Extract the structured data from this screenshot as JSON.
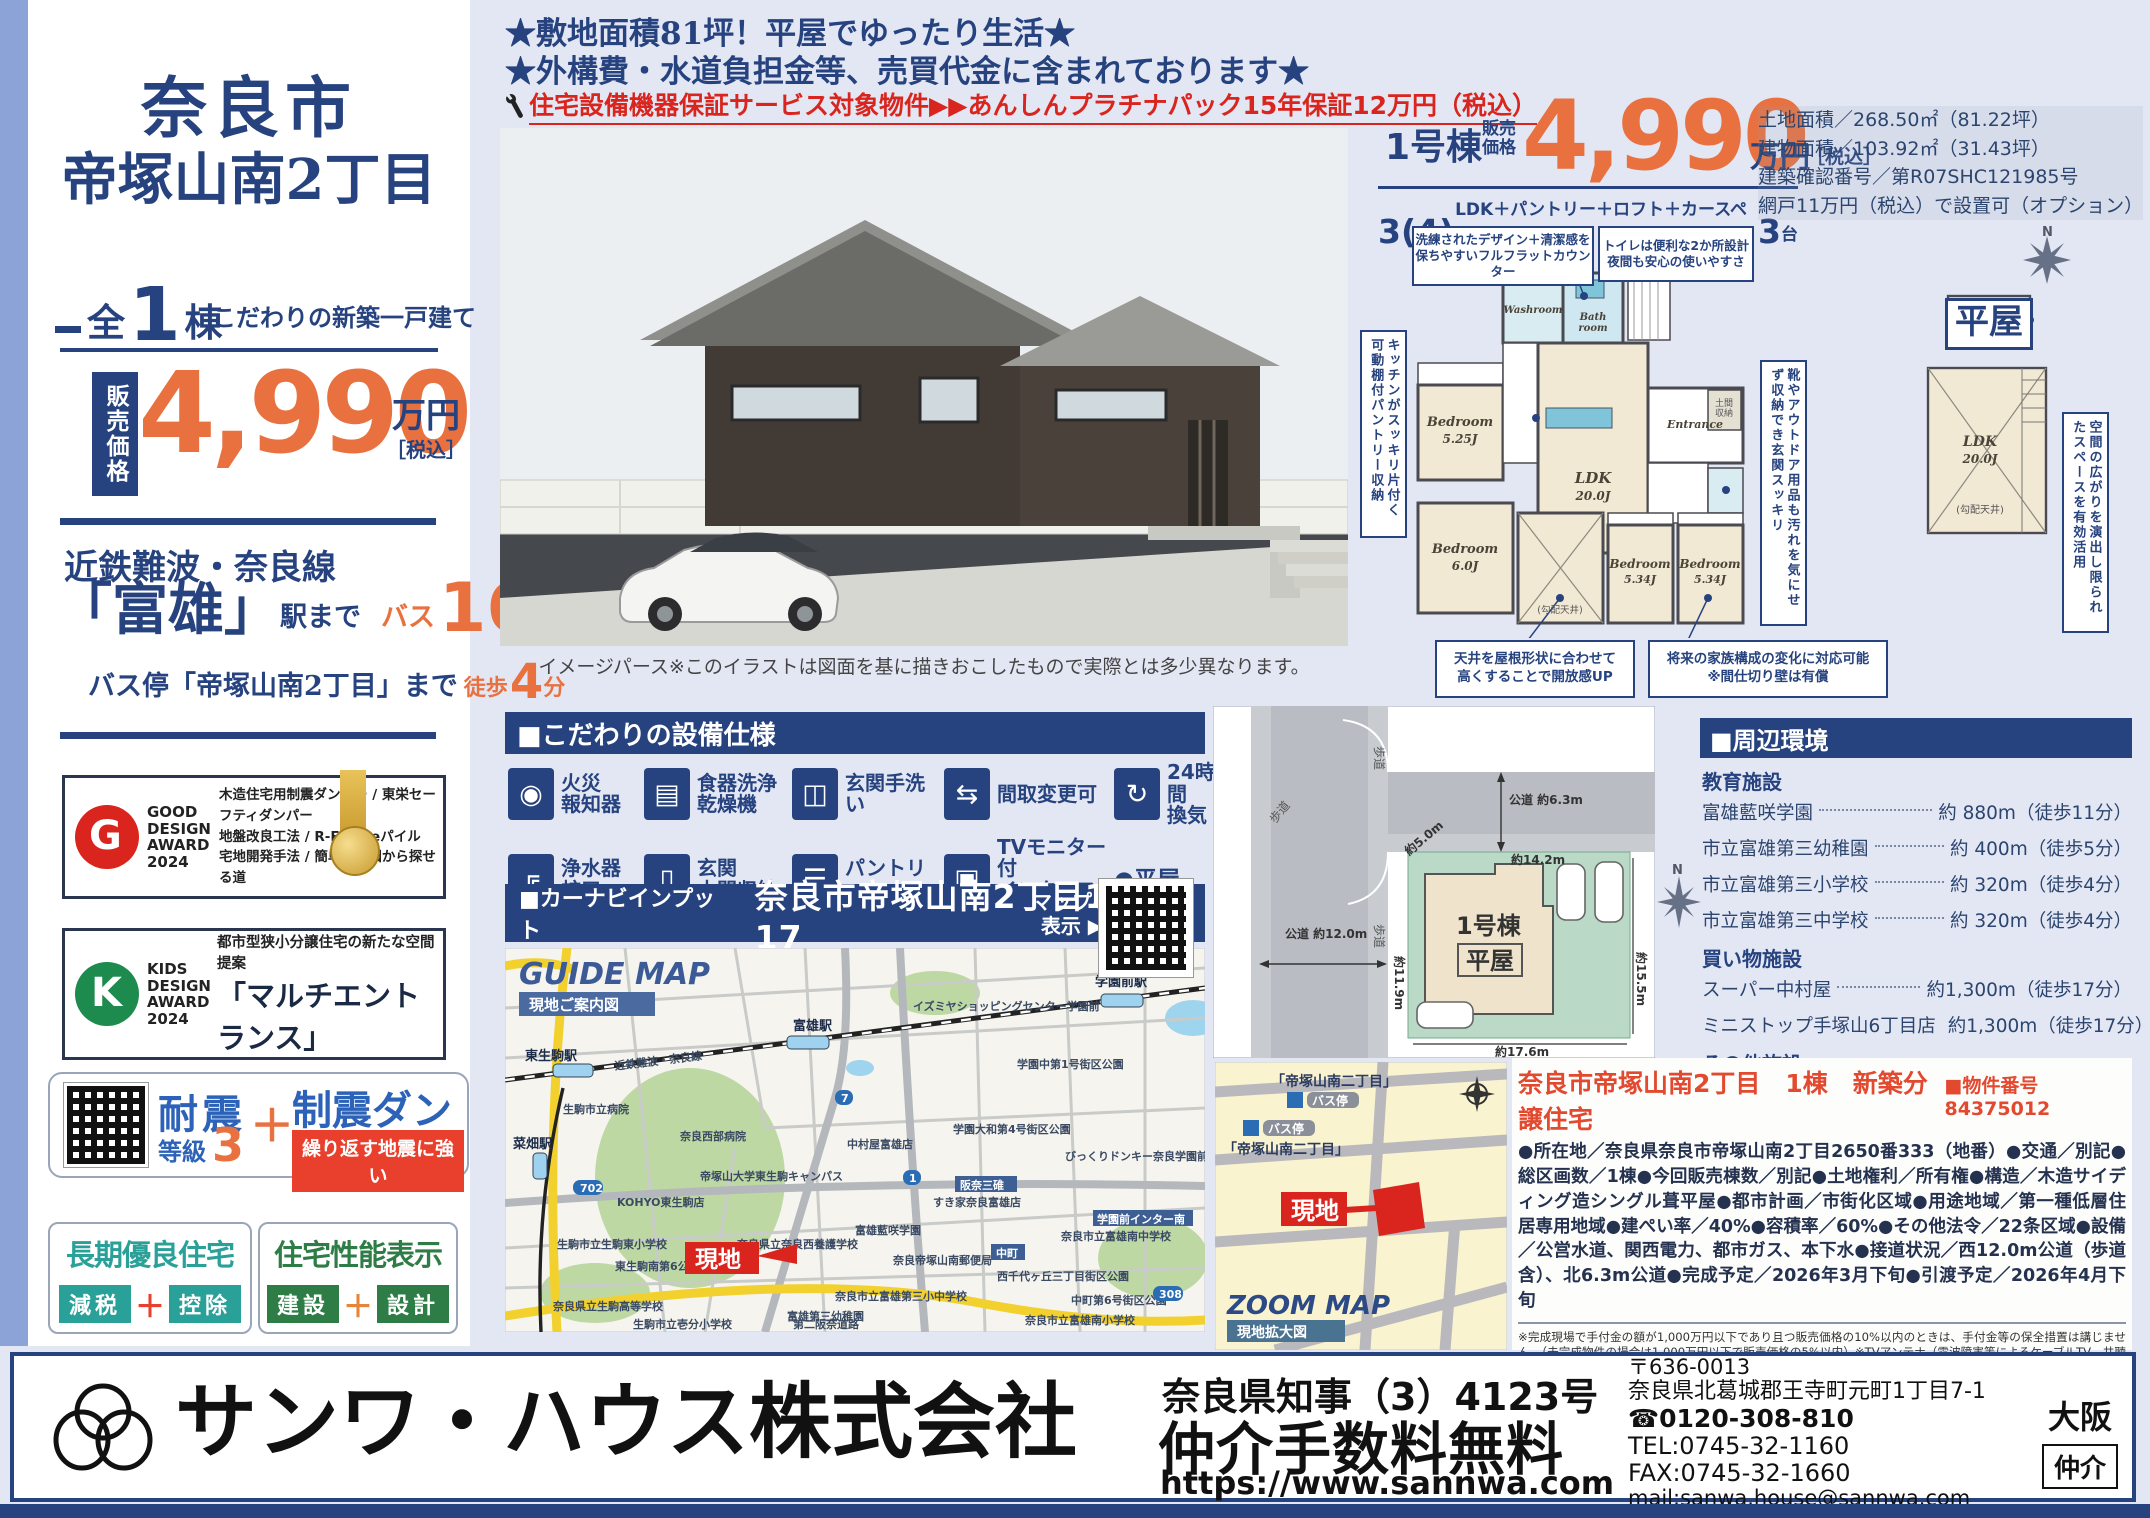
{
  "top": {
    "star1": "★敷地面積81坪！平屋でゆったり生活★",
    "star2": "★外構費・水道負担金等、売買代金に含まれております★",
    "warranty": "住宅設備機器保証サービス対象物件▶▶あんしんプラチナパック15年保証12万円（税込）"
  },
  "sidebar": {
    "title1": "奈良市",
    "title2": "帝塚山南2丁目",
    "zen": "全",
    "count": "1",
    "tou": "棟",
    "note": "こだわりの新築一戸建て",
    "price_label": "販売価格",
    "price": "4,990",
    "price_unit": "万円",
    "price_tax": "［税込］",
    "line_name": "近鉄難波・奈良線",
    "station": "「富雄」",
    "station_suffix": "駅まで",
    "bus_word": "バス",
    "bus_num": "16",
    "bus_unit": "分",
    "busstop": "バス停「帝塚山南2丁目」まで",
    "walk_word": "徒歩",
    "walk_num": "4",
    "walk_unit": "分",
    "gd_award": "GOOD\nDESIGN\nAWARD\n2024",
    "gd_line1": "木造住宅用制震ダンパー / 東栄セーフティダンパー",
    "gd_line2": "地盤改良工法 / R-Evolveパイル",
    "gd_line3": "宅地開発手法 / 簡単に地図から探せる道",
    "kd_award": "KIDS\nDESIGN\nAWARD\n2024",
    "kd_line1": "都市型狭小分譲住宅の新たな空間提案",
    "kd_line2": "「マルチエントランス」",
    "ts_word1": "耐震",
    "ts_grade": "等級",
    "ts_num": "3",
    "ts_plus": "＋",
    "ts_word2": "制震ダンパー",
    "ts_band": "繰り返す地震に強い",
    "ch_title": "長期優良住宅",
    "ch_left": "減税",
    "ch_plus": "＋",
    "ch_right": "控除",
    "sp_title": "住宅性能表示",
    "sp_left": "建設",
    "sp_plus": "＋",
    "sp_right": "設計"
  },
  "render_caption": "イメージパース※このイラストは図面を基に描きおこしたもので実際とは多少異なります。",
  "price_block": {
    "unit": "1号棟",
    "label": "販売\n価格",
    "price": "4,990",
    "yen": "万円",
    "tax": "［税込］",
    "plan_big": "3(4)",
    "plan_mid": "LDK＋パントリー＋ロフト＋カースペース",
    "plan_num": "3",
    "plan_tail": "台",
    "detail1": "土地面積／268.50㎡（81.22坪）",
    "detail2": "建物面積／103.92㎡（31.43坪）",
    "detail3": "建築確認番号／第R07SHC121985号",
    "detail4": "網戸11万円（税込）で設置可（オプション）"
  },
  "floorplan": {
    "badge": "平屋",
    "c_counter": "洗練されたデザイン＋清潔感を\n保ちやすいフルフラットカウンター",
    "c_toilet": "トイレは便利な2か所設計\n夜間も安心の使いやすさ",
    "c_kitchen": "キッチンがスッキリ片付く可動棚付パントリー収納",
    "c_entrance": "靴やアウトドア用品も汚れを気にせず収納でき玄関スッキリ",
    "c_loft": "空間の広がりを演出し限られたスペースを有効活用",
    "c_ceiling": "天井を屋根形状に合わせて\n高くすることで開放感UP",
    "c_future": "将来の家族構成の変化に対応可能\n※間仕切り壁は有償",
    "bed1a": "Bedroom",
    "bed1b": "5.25J",
    "bed2a": "Bedroom",
    "bed2b": "6.0J",
    "ldka": "LDK",
    "ldkb": "20.0J",
    "bed3a": "Bedroom",
    "bed3b": "5.34J",
    "bed4a": "Bedroom",
    "bed4b": "5.34J",
    "wash": "Washroom",
    "bath1": "Bath",
    "bath2": "room",
    "ent": "Entrance",
    "doma1": "土間",
    "doma2": "収納",
    "slope": "(勾配天井)",
    "loft1": "ロフト",
    "loft2": "3.72㎡",
    "loft3": "LDK",
    "loft4": "20.0J",
    "loft5": "(勾配天井)",
    "north": "N"
  },
  "specs": {
    "title": "■こだわりの設備仕様",
    "items": [
      {
        "glyph": "◉",
        "label": "火災\n報知器"
      },
      {
        "glyph": "▤",
        "label": "食器洗浄\n乾燥機"
      },
      {
        "glyph": "◫",
        "label": "玄関手洗い"
      },
      {
        "glyph": "⇆",
        "label": "間取変更可"
      },
      {
        "glyph": "↻",
        "label": "24時間\n換気"
      },
      {
        "glyph": "╔",
        "label": "浄水器\n蛇口"
      },
      {
        "glyph": "▯",
        "label": "玄関\n土間収納"
      },
      {
        "glyph": "☰",
        "label": "パントリー"
      },
      {
        "glyph": "▣",
        "label": "TVモニター付\nインターフォン"
      },
      {
        "glyph": "",
        "label": "●平屋"
      }
    ]
  },
  "carnav": {
    "label": "■カーナビインプット",
    "address": "奈良市帝塚山南2丁目14番17",
    "btn": "マップを\n表示 ▶"
  },
  "guide_map": {
    "title": "GUIDE MAP",
    "subtitle": "現地ご案内図",
    "genchi": "現地",
    "rail": "近鉄難波・奈良線",
    "routes": [
      "702",
      "7",
      "1",
      "308"
    ],
    "tags": [
      "阪奈三碓",
      "学園前インター南",
      "中町"
    ],
    "labels": [
      "東生駒駅",
      "富雄駅",
      "学園前駅",
      "菜畑駅",
      "生駒市立病院",
      "奈良西部病院",
      "帝塚山大学東生駒キャンパス",
      "KOHYO東生駒店",
      "中村屋富雄店",
      "イズミヤショッピングセンター学園前",
      "学園中第1号街区公園",
      "学園大和第4号街区公園",
      "びっくりドンキー奈良学園前店",
      "すき家奈良富雄店",
      "富雄藍咲学園",
      "奈良県立奈良西養護学校",
      "奈良帝塚山南郵便局",
      "西千代ヶ丘三丁目街区公園",
      "中町第6号街区公園",
      "奈良市立富雄南中学校",
      "奈良市立富雄南小学校",
      "奈良市立富雄第三小中学校",
      "富雄第三幼稚園",
      "東生駒南第6公園",
      "生駒市立生駒東小学校",
      "奈良県立生駒高等学校",
      "生駒市立壱分小学校",
      "第二阪奈道路"
    ]
  },
  "site_plan": {
    "road_top": "公道\n約6.3m",
    "road_left": "公道\n約12.0m",
    "walk": "歩道",
    "d_top": "約14.2m",
    "d_right": "約15.5m",
    "d_bottom": "約17.6m",
    "d_left": "約11.9m",
    "d_diag": "約5.0m",
    "bld1": "1号棟",
    "bld2": "平屋",
    "north": "N"
  },
  "surroundings": {
    "title": "■周辺環境",
    "g1": "教育施設",
    "g1r1n": "富雄藍咲学園",
    "g1r1d": "約 880m（徒歩11分）",
    "g1r2n": "市立富雄第三幼稚園",
    "g1r2d": "約 400m（徒歩5分）",
    "g1r3n": "市立富雄第三小学校",
    "g1r3d": "約 320m（徒歩4分）",
    "g1r4n": "市立富雄第三中学校",
    "g1r4d": "約 320m（徒歩4分）",
    "g2": "買い物施設",
    "g2r1n": "スーパー中村屋",
    "g2r1d": "約1,300m（徒歩17分）",
    "g2r2n": "ミニストップ手塚山6丁目店",
    "g2r2d": "約1,300m（徒歩17分）",
    "g3": "その他施設",
    "g3r1n": "奈良帝塚山南郵便局",
    "g3r1d": "約 550m（徒歩7分）"
  },
  "zoom_map": {
    "title": "ZOOM MAP",
    "subtitle": "現地拡大図",
    "stop_name": "「帝塚山南二丁目」",
    "stop_badge": "バス停",
    "genchi": "現地"
  },
  "property": {
    "header": "奈良市帝塚山南2丁目　1棟　新築分譲住宅",
    "number": "■物件番号 84375012",
    "body": "●所在地／奈良県奈良市帝塚山南2丁目2650番333（地番）●交通／別記●総区画数／1棟●今回販売棟数／別記●土地権利／所有権●構造／木造サイディング造シングル葺平屋●都市計画／市街化区域●用途地域／第一種低層住居専用地域●建ぺい率／40%●容積率／60%●その他法令／22条区域●設備／公営水道、関西電力、都市ガス、本下水●接道状況／西12.0m公道（歩道含）、北6.3m公道●完成予定／2026年3月下旬●引渡予定／2026年4月下旬",
    "fine": "※完成現場で手付金の額が1,000万円以下であり且つ販売価格の10%以内のときは、手付金等の保全措置は講じません。（未完成物件の場合は1,000万円以下で販売価格の5%以内）※TVアンテナ（電波障害等によるケーブルTV、共聴アンテナ）の申込みはお客様負担となります。※電気の供給の為、敷地内に電柱及び支線が入る場合があります。※図面と現況の相違がある場合は現況優先にてご了承願います。※当社の物件のインターネット又折込広告掲載の場合については必ず当社まで一報下さい。※消費税について引き渡し時の税率を適用します。※司法書士、土地家屋調査士は当社指定とさせていただきます。※網戸は東栄ホームサービスへの発注となります。尚表示価格は建物引渡20日前迄の申込が条件となります。※FIX窓・ドア（玄関・勝手口・テラス）は対象外となります。"
  },
  "footer": {
    "company": "サンワ・ハウス株式会社",
    "license": "奈良県知事（3）4123号",
    "fee": "仲介手数料無料",
    "url": "https://www.sannwa.com",
    "postal": "〒636-0013",
    "address": "奈良県北葛城郡王寺町元町1丁目7-1",
    "freedial": "☎0120-308-810",
    "tel": "TEL:0745-32-1160",
    "fax": "FAX:0745-32-1660",
    "mail": "mail:sanwa.house@sannwa.com",
    "area": "大阪",
    "broker": "仲介"
  }
}
